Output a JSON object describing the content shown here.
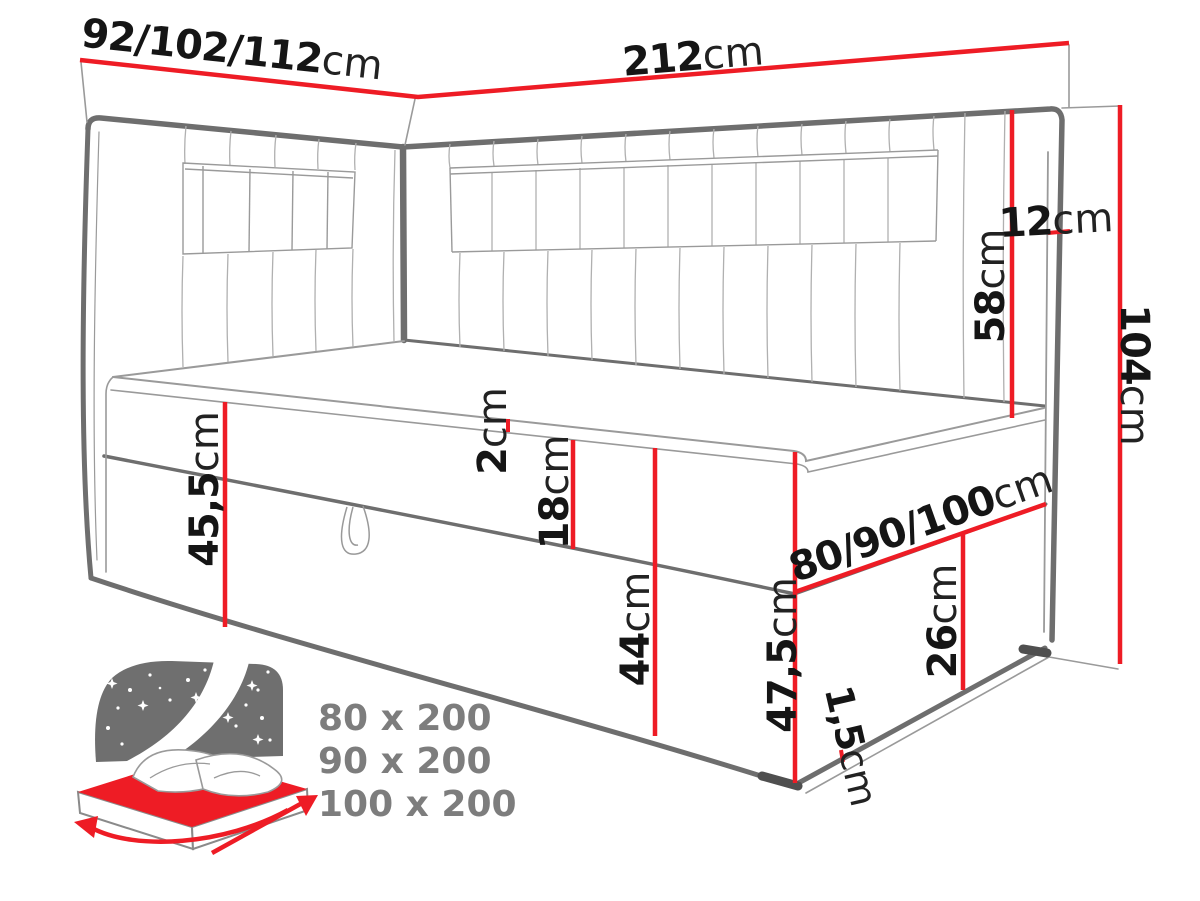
{
  "colors": {
    "accent_red": "#ee1c25",
    "outline_gray": "#6e6e6e",
    "thin_gray": "#9a9a9a",
    "label_black": "#151515",
    "icon_gray": "#6f6f6f",
    "sizes_gray": "#7d7d7d"
  },
  "diagram": {
    "dimensions": {
      "back_width": {
        "value": "92/102/112",
        "unit": "cm"
      },
      "total_length": {
        "value": "212",
        "unit": "cm"
      },
      "headboard_thickness": {
        "value": "12",
        "unit": "cm"
      },
      "headboard_above_mattress": {
        "value": "58",
        "unit": "cm"
      },
      "total_height": {
        "value": "104",
        "unit": "cm"
      },
      "topper_height": {
        "value": "2",
        "unit": "cm"
      },
      "mattress_height": {
        "value": "18",
        "unit": "cm"
      },
      "left_height": {
        "value": "45,5",
        "unit": "cm"
      },
      "base_height": {
        "value": "44",
        "unit": "cm"
      },
      "corner_height": {
        "value": "47,5",
        "unit": "cm"
      },
      "bed_width": {
        "value": "80/90/100",
        "unit": "cm"
      },
      "side_base_height": {
        "value": "26",
        "unit": "cm"
      },
      "floor_clearance": {
        "value": "1,5",
        "unit": "cm"
      }
    },
    "available_sizes": [
      "80 x 200",
      "90 x 200",
      "100 x 200"
    ]
  }
}
